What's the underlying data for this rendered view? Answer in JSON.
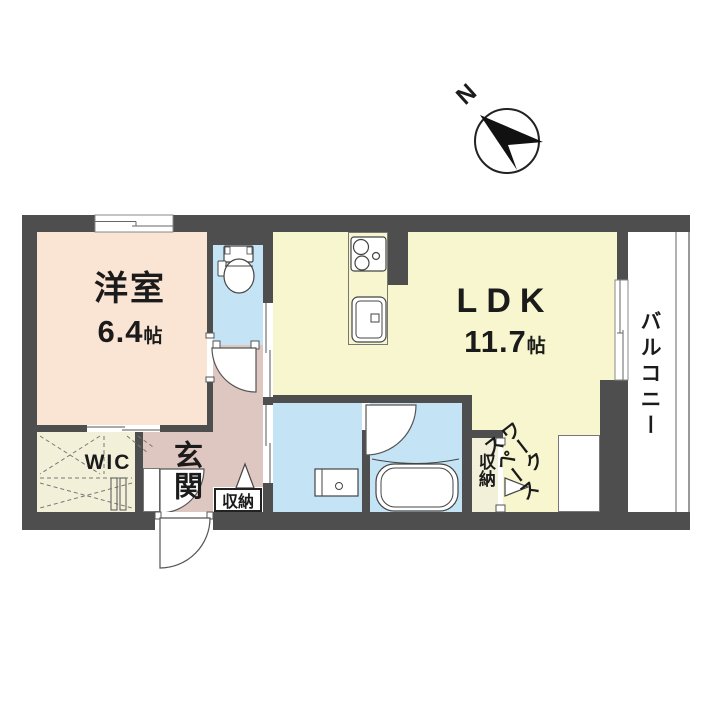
{
  "compass": {
    "label": "N"
  },
  "rooms": {
    "western_room": {
      "name": "洋室",
      "size_value": "6.4",
      "size_unit": "帖"
    },
    "ldk": {
      "name": "LDK",
      "size_value": "11.7",
      "size_unit": "帖"
    },
    "balcony": {
      "name": "バルコニー"
    },
    "wic": {
      "name": "WIC"
    },
    "entrance": {
      "name": "玄関"
    },
    "hall_storage": {
      "name": "収納"
    },
    "work_storage": {
      "name": "収納"
    },
    "workspace": {
      "name": "ワーク\nスペース"
    }
  },
  "colors": {
    "wall": "#4e4e4e",
    "western_room": "#fae4d3",
    "ldk": "#f8f6ce",
    "wet_area": "#c4e4f5",
    "hall": "#dec7c0",
    "closet": "#f3f0d9",
    "line": "#555555"
  }
}
